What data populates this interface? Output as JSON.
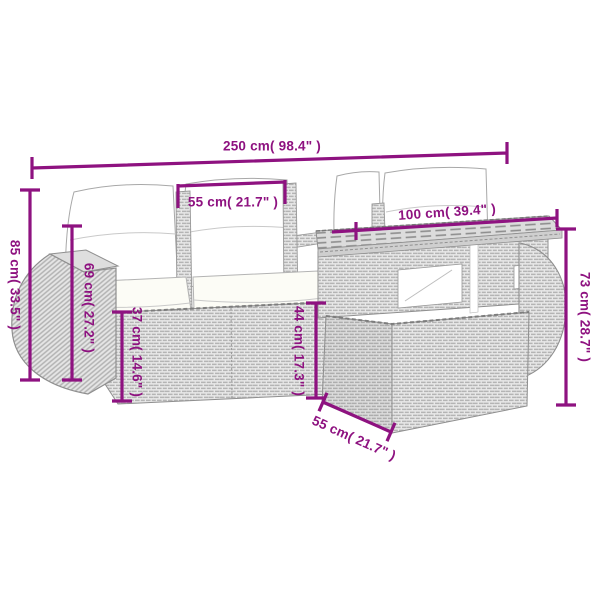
{
  "illustration_description": "Dimension diagram of a grey poly rattan garden lounge set: sofa with white cushions, rounded armrest and rattan table with slatted top",
  "dimensions": {
    "total_width": "250 cm( 98.4\" )",
    "cushion_width": "55 cm( 21.7\" )",
    "table_top_width": "100 cm( 39.4\" )",
    "sofa_height": "85 cm( 33.5\" )",
    "backrest_height": "69 cm( 27.2\" )",
    "seat_height": "37 cm( 14.6\" )",
    "seat_cushion_height": "44 cm( 17.3\" )",
    "table_height": "73 cm( 28.7\" )",
    "table_depth": "55 cm( 21.7\" )"
  },
  "colors": {
    "dimension": "#8E1280",
    "background": "#FFFFFF"
  }
}
